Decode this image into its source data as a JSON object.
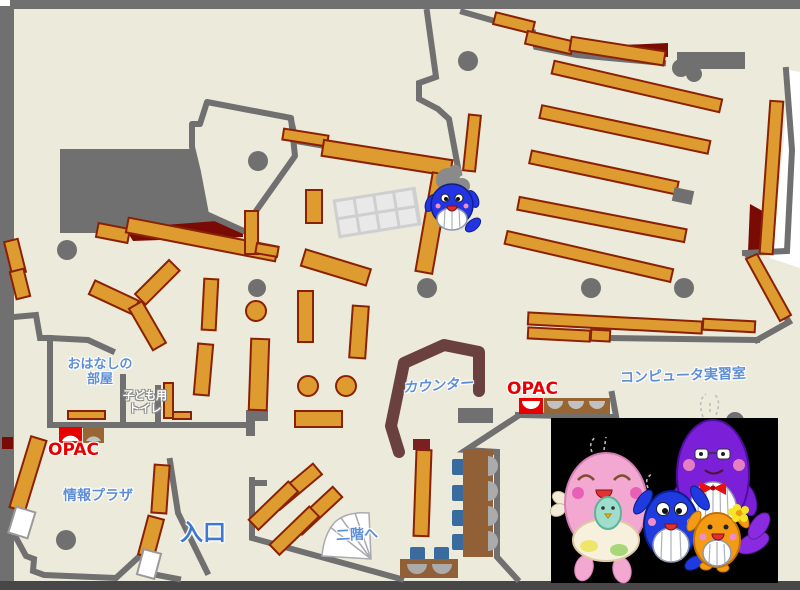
{
  "page": {
    "title": "図書館1階 フロアマップ"
  },
  "labels": {
    "storytelling1": "おはなしの",
    "storytelling2": "部屋",
    "toilet1": "子ども用",
    "toilet2": "トイレ",
    "opac_left": "OPAC",
    "opac_center": "OPAC",
    "info_plaza": "情報プラザ",
    "entrance": "入口",
    "second_floor": "二階へ",
    "counter": "カウンター",
    "computer_room": "コンピュータ実習室"
  },
  "colors": {
    "floor": "#eceadb",
    "wall_gray": "#707070",
    "bottom_band": "#474747",
    "shelf_orange": "#de9b30",
    "shelf_outline": "#8b2104",
    "dark_red": "#7a0b04",
    "counter_brown": "#6b4140",
    "desk_brown": "#916036",
    "chair_blue": "#3a6b9e",
    "seat_gray": "#ababab",
    "label_blue": "#5e8fd6",
    "opac_red": "#e60000",
    "photo_background": "#000000"
  },
  "mascots": {
    "floor_mascot": "blue-whale-mascot",
    "photo_mascots": [
      "pink-whale-mascot",
      "blue-whale-mascot",
      "purple-whale-mascot",
      "orange-whale-mascot"
    ]
  }
}
